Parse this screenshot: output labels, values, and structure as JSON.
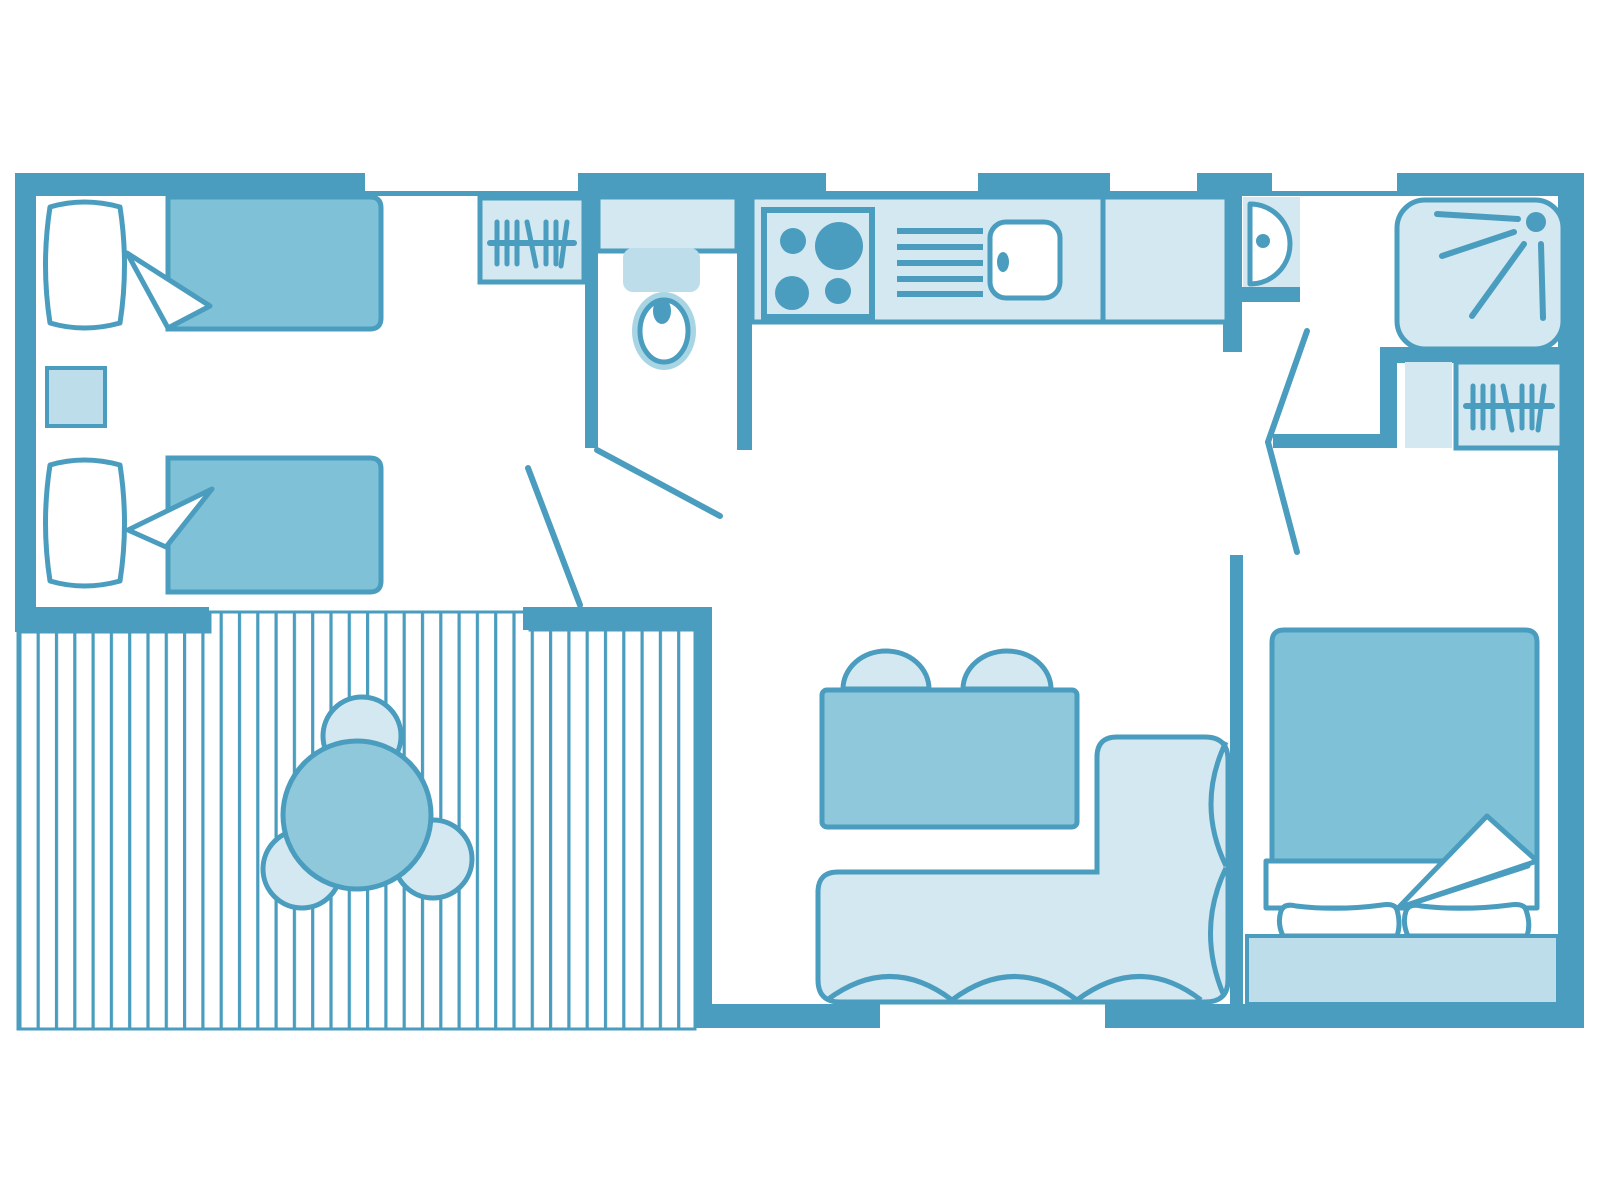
{
  "canvas": {
    "width": 1600,
    "height": 1200,
    "background": "#FFFFFF"
  },
  "palette": {
    "wall": "#4A9DBE",
    "furniture_medium": "#7FC2D8",
    "table_medium": "#8FC8DB",
    "furniture_light": "#D3E8F0",
    "furniture_light_alt": "#BCDDE9",
    "bowl_ring": "#A8D5E4",
    "deck_stripe": "#4A9DBE",
    "white": "#FFFFFF"
  },
  "floorplan": {
    "type": "mobile-home floor plan",
    "style": "blue line-art, top-down view, no text labels",
    "rooms": [
      {
        "name": "twin-bedroom",
        "furniture": [
          "single-bed",
          "single-bed",
          "nightstand"
        ]
      },
      {
        "name": "terrace-deck",
        "furniture": [
          "decking-planks",
          "round-table",
          "chair",
          "chair",
          "chair"
        ]
      },
      {
        "name": "hallway",
        "furniture": [
          "hanging-wardrobe"
        ]
      },
      {
        "name": "wc",
        "furniture": [
          "vanity-shelf",
          "toilet"
        ]
      },
      {
        "name": "kitchen",
        "furniture": [
          "counter",
          "hob-4-burners",
          "draining-board",
          "sink"
        ]
      },
      {
        "name": "shower-room",
        "furniture": [
          "washbasin",
          "shower-cubicle",
          "shelf",
          "hanging-wardrobe"
        ]
      },
      {
        "name": "living-room",
        "furniture": [
          "dining-table",
          "chair",
          "chair",
          "corner-sofa"
        ]
      },
      {
        "name": "double-bedroom",
        "furniture": [
          "double-bed",
          "pillow",
          "pillow",
          "headboard-bench"
        ]
      }
    ],
    "window_count": 4,
    "door_swing_count": 3
  }
}
